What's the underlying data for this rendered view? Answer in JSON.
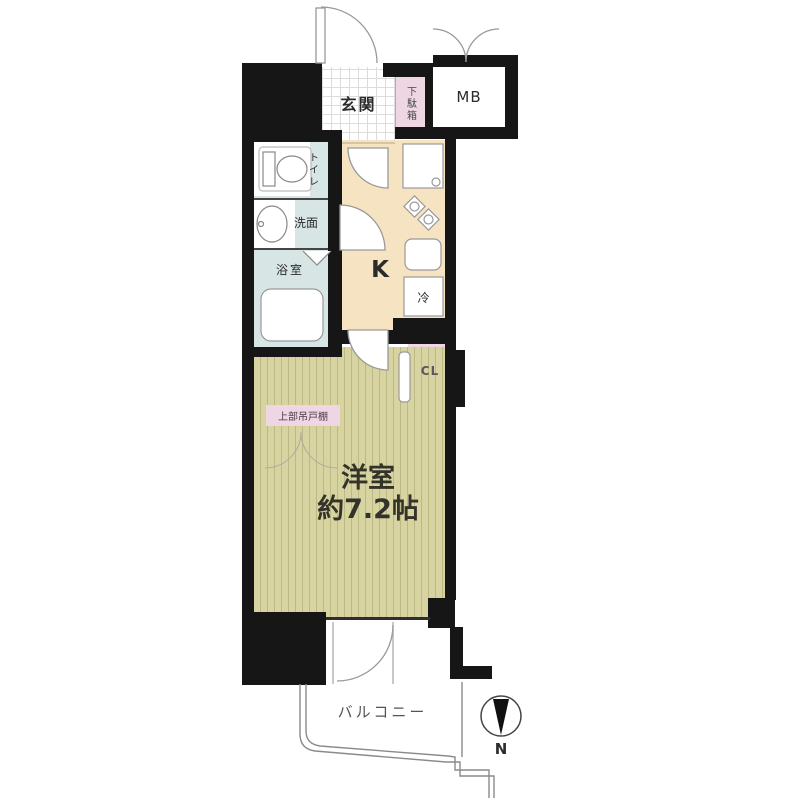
{
  "plan": {
    "rooms": {
      "genkan": {
        "label": "玄関"
      },
      "shoe_cabinet": {
        "label": "下駄箱"
      },
      "meter_box": {
        "label": "MB"
      },
      "toilet": {
        "label": "トイレ"
      },
      "washroom": {
        "label": "洗面"
      },
      "bathroom": {
        "label": "浴室"
      },
      "kitchen": {
        "label": "K"
      },
      "refrigerator": {
        "label": "冷"
      },
      "closet": {
        "label": "CL"
      },
      "main_room": {
        "label": "洋室",
        "size": "約7.2帖"
      },
      "upper_cabinet": {
        "label": "上部吊戸棚"
      },
      "balcony": {
        "label": "バルコニー"
      }
    },
    "compass": {
      "label": "N",
      "needle_direction": "down"
    },
    "colors": {
      "wall": "#161616",
      "wet_area_blue": "#d7e6e4",
      "kitchen_cream": "#f6e3c2",
      "closet_pink": "#eed6e2",
      "flooring_tatami": "#d8d4a2"
    }
  }
}
